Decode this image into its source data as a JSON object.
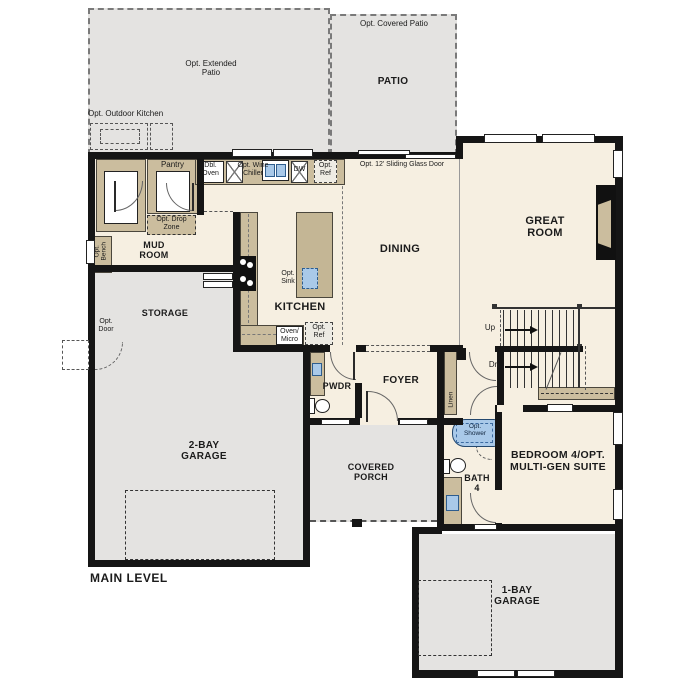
{
  "plan": {
    "title": "MAIN LEVEL",
    "rooms": {
      "extended_patio": "Opt. Extended Patio",
      "covered_patio": "Opt. Covered Patio",
      "patio": "PATIO",
      "outdoor_kitchen": "Opt. Outdoor Kitchen",
      "great_room": "GREAT ROOM",
      "dining": "DINING",
      "kitchen": "KITCHEN",
      "mud_room": "MUD ROOM",
      "pantry": "Pantry",
      "storage": "STORAGE",
      "two_bay_garage": "2-BAY GARAGE",
      "pwdr": "PWDR",
      "foyer": "FOYER",
      "covered_porch": "COVERED PORCH",
      "bath_4": "BATH 4",
      "bedroom_4": "BEDROOM 4/OPT. MULTI-GEN SUITE",
      "one_bay_garage": "1-BAY GARAGE"
    },
    "features": {
      "dbl_oven": "Dbl. Oven",
      "opt_wine_chiller": "Opt. Wine Chiller",
      "dw": "DW",
      "opt_ref": "Opt. Ref",
      "sliding_door": "Opt. 12' Sliding Glass Door",
      "opt_drop_zone": "Opt. Drop Zone",
      "opt_bench": "Opt. Bench",
      "opt_door": "Opt. Door",
      "opt_sink": "Opt. Sink",
      "oven_micro": "Oven/ Micro",
      "up": "Up",
      "dn": "Dn",
      "linen": "Linen",
      "opt_shower": "Opt. Shower"
    },
    "colors": {
      "outdoor_fill": "#e4e3e1",
      "interior_fill": "#f6efe1",
      "cabinet_fill": "#cbbd9e",
      "fixture_blue": "#a9c9e9",
      "wall": "#151515"
    }
  }
}
